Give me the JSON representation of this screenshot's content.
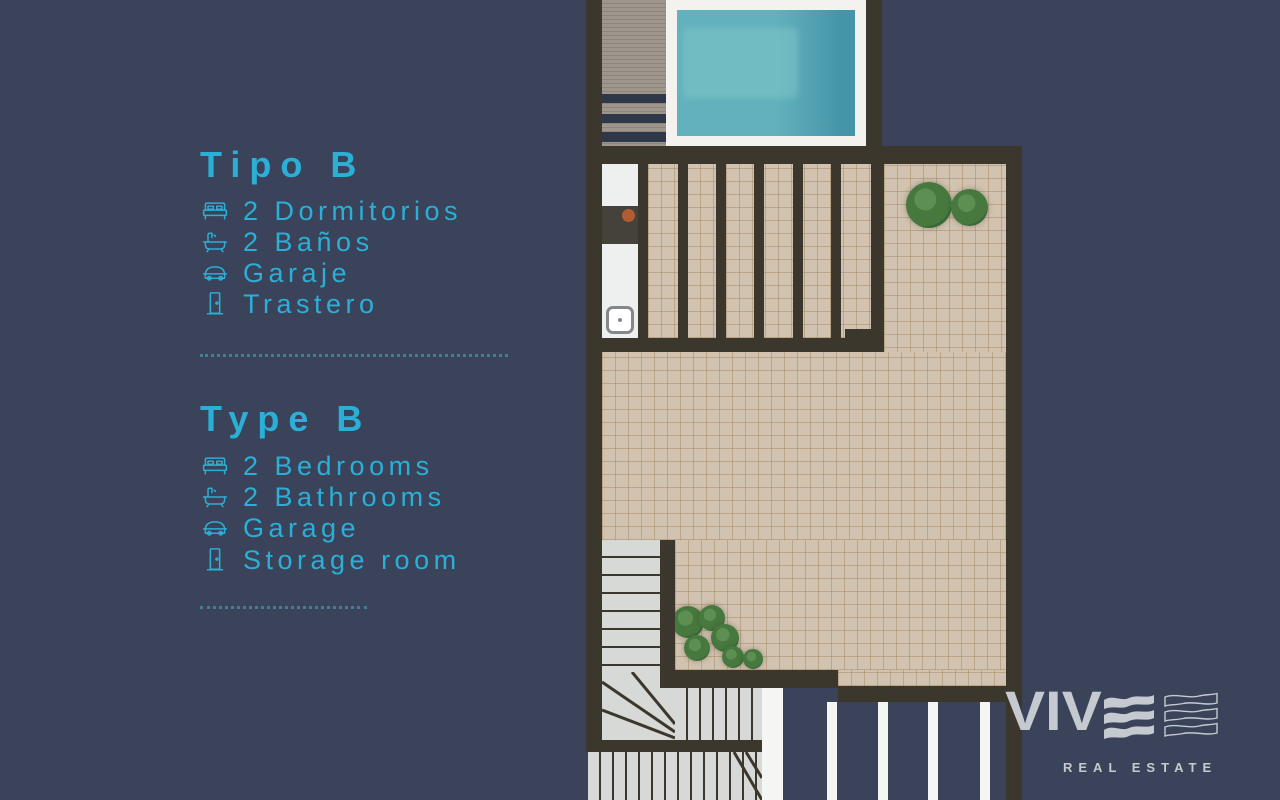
{
  "palette": {
    "background": "#3a4359",
    "accent_cyan": "#2bafd6",
    "dotted_line": "#3e7f99",
    "wall": "#3b372d",
    "tile": "#d2c3b0",
    "tile_line": "#bba98f",
    "deck": "#9e958c",
    "deck_line": "#8d847c",
    "deck_band": "#2f3848",
    "pool_deck": "#f3f2ee",
    "water_light": "#7fc5c8",
    "water": "#62b2bd",
    "water_dark": "#4595a9",
    "steps": "#d7d9d6",
    "plant": "#47793f",
    "plant_dark": "#3a6837",
    "white": "#f5f5f3",
    "kitchen_counter": "#45423b",
    "kitchen_accent": "#b15c33",
    "logo_gray": "#c5c9d0"
  },
  "panel_es": {
    "title": "Tipo B",
    "items": [
      {
        "icon": "bed-icon",
        "label": "2 Dormitorios"
      },
      {
        "icon": "bath-icon",
        "label": "2 Baños"
      },
      {
        "icon": "car-icon",
        "label": "Garaje"
      },
      {
        "icon": "door-icon",
        "label": "Trastero"
      }
    ]
  },
  "panel_en": {
    "title": "Type B",
    "items": [
      {
        "icon": "bed-icon",
        "label": "2 Bedrooms"
      },
      {
        "icon": "bath-icon",
        "label": "2 Bathrooms"
      },
      {
        "icon": "car-icon",
        "label": "Garage"
      },
      {
        "icon": "door-icon",
        "label": "Storage room"
      }
    ]
  },
  "brand": {
    "wordmark": "VIV",
    "wordmark_full": "VIVE",
    "tagline": "REAL ESTATE"
  },
  "floorplan": {
    "type": "roof-terrace-plan",
    "features": [
      "swimming-pool",
      "wood-deck",
      "pergola-slats",
      "outdoor-kitchen",
      "tiled-terrace",
      "planted-trees",
      "staircase",
      "lower-pergola"
    ]
  }
}
